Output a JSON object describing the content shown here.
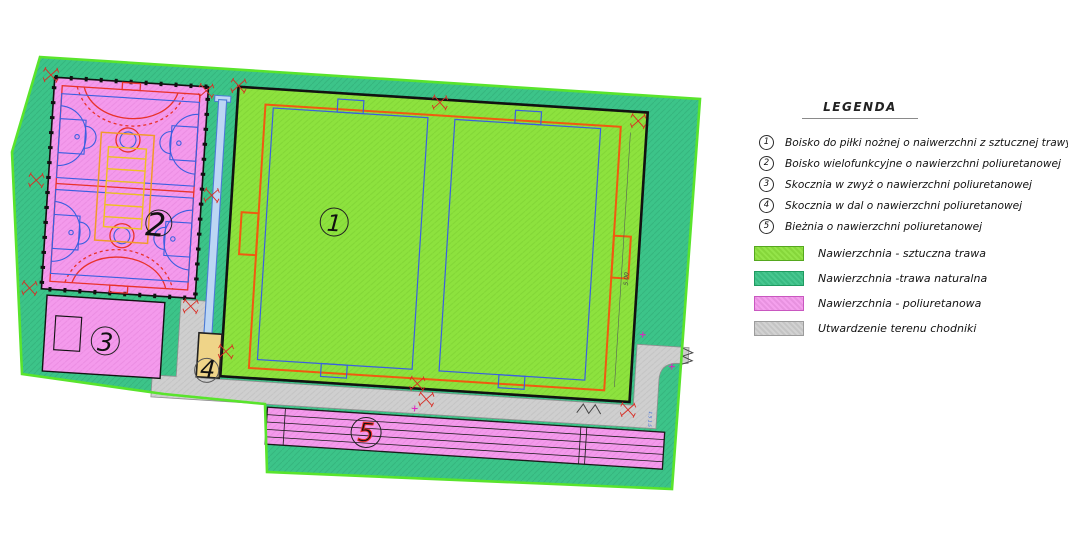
{
  "legend": {
    "title": "LEGENDA",
    "items": [
      {
        "num": "1",
        "label": "Boisko do piłki nożnej o naiwerzchni z sztucznej trawy"
      },
      {
        "num": "2",
        "label": "Boisko wielofunkcyjne o nawierzchni poliuretanowej"
      },
      {
        "num": "3",
        "label": "Skocznia w zwyż o nawierzchni poliuretanowej"
      },
      {
        "num": "4",
        "label": "Skocznia w dal o nawierzchni poliuretanowej"
      },
      {
        "num": "5",
        "label": "Bieżnia o nawierzchni poliuretanowej"
      }
    ],
    "surfaces": [
      {
        "label": "Nawierzchnia - sztuczna trawa",
        "color": "#8DE23E",
        "border": "#55A81E"
      },
      {
        "label": "Nawierzchnia -trawa naturalna",
        "color": "#3CC489",
        "border": "#1F9A60"
      },
      {
        "label": "Nawierzchnia - poliuretanowa",
        "color": "#F49AEC",
        "border": "#C957C0"
      },
      {
        "label": "Utwardzenie terenu chodniki",
        "color": "#CFCFCF",
        "border": "#9C9C9C"
      }
    ]
  },
  "plan": {
    "markers": [
      {
        "num": "1"
      },
      {
        "num": "2"
      },
      {
        "num": "3"
      },
      {
        "num": "4"
      },
      {
        "num": "5"
      }
    ],
    "annotations": {
      "field_dim": "5.00",
      "path_dim": "1.5 1.5"
    }
  },
  "colors": {
    "plot_fill": "#3CC489",
    "plot_border": "#59E42C",
    "turf": "#8DE23E",
    "poly_pink": "#F49AEC",
    "walkway": "#CFCFCF",
    "pitch_orange": "#F05A10",
    "court_red": "#E8322A",
    "court_blue": "#3A5FE0",
    "volley_yellow": "#F0C020",
    "volley_orange": "#F09A28",
    "runway_fill": "#BCD6F4",
    "runway_line": "#4B7BD6",
    "sand": "#EFD488",
    "symbol_red": "#D92C23",
    "survey_magenta": "#E020C0"
  }
}
